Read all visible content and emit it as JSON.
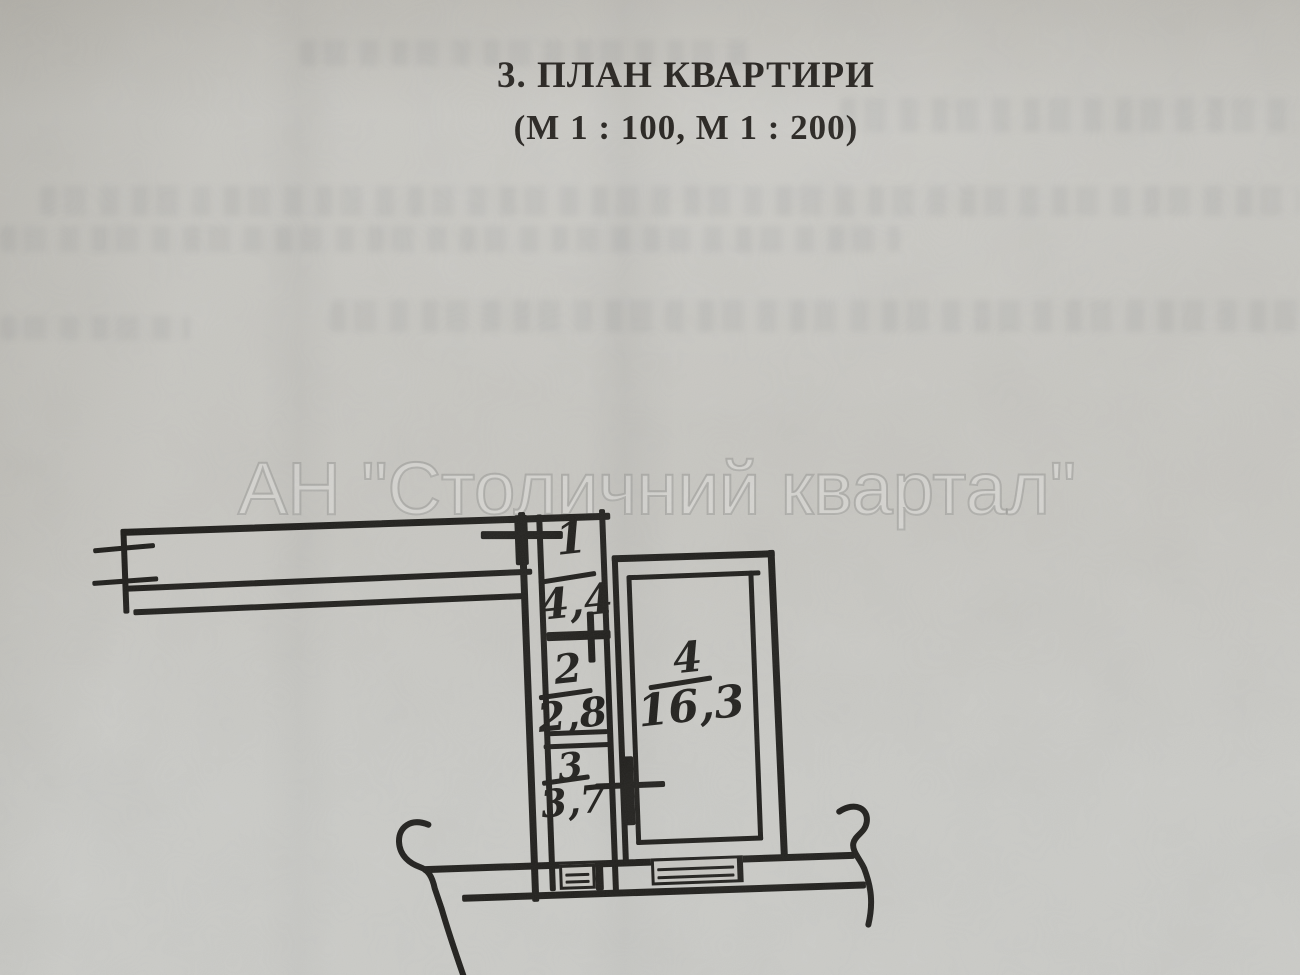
{
  "header": {
    "title": "3. ПЛАН КВАРТИРИ",
    "subtitle": "(М 1 : 100, М 1 : 200)"
  },
  "watermark": {
    "text": "АН \"Столичний квартал\""
  },
  "plan": {
    "rooms": [
      {
        "number": "1",
        "area": "4,4"
      },
      {
        "number": "2",
        "area": "2,8"
      },
      {
        "number": "3",
        "area": "3,7"
      },
      {
        "number": "4",
        "area": "16,3"
      }
    ]
  },
  "colors": {
    "ink": "#1f1e1b",
    "paper": "#c7c6c1",
    "watermark": "#9a9a97"
  }
}
